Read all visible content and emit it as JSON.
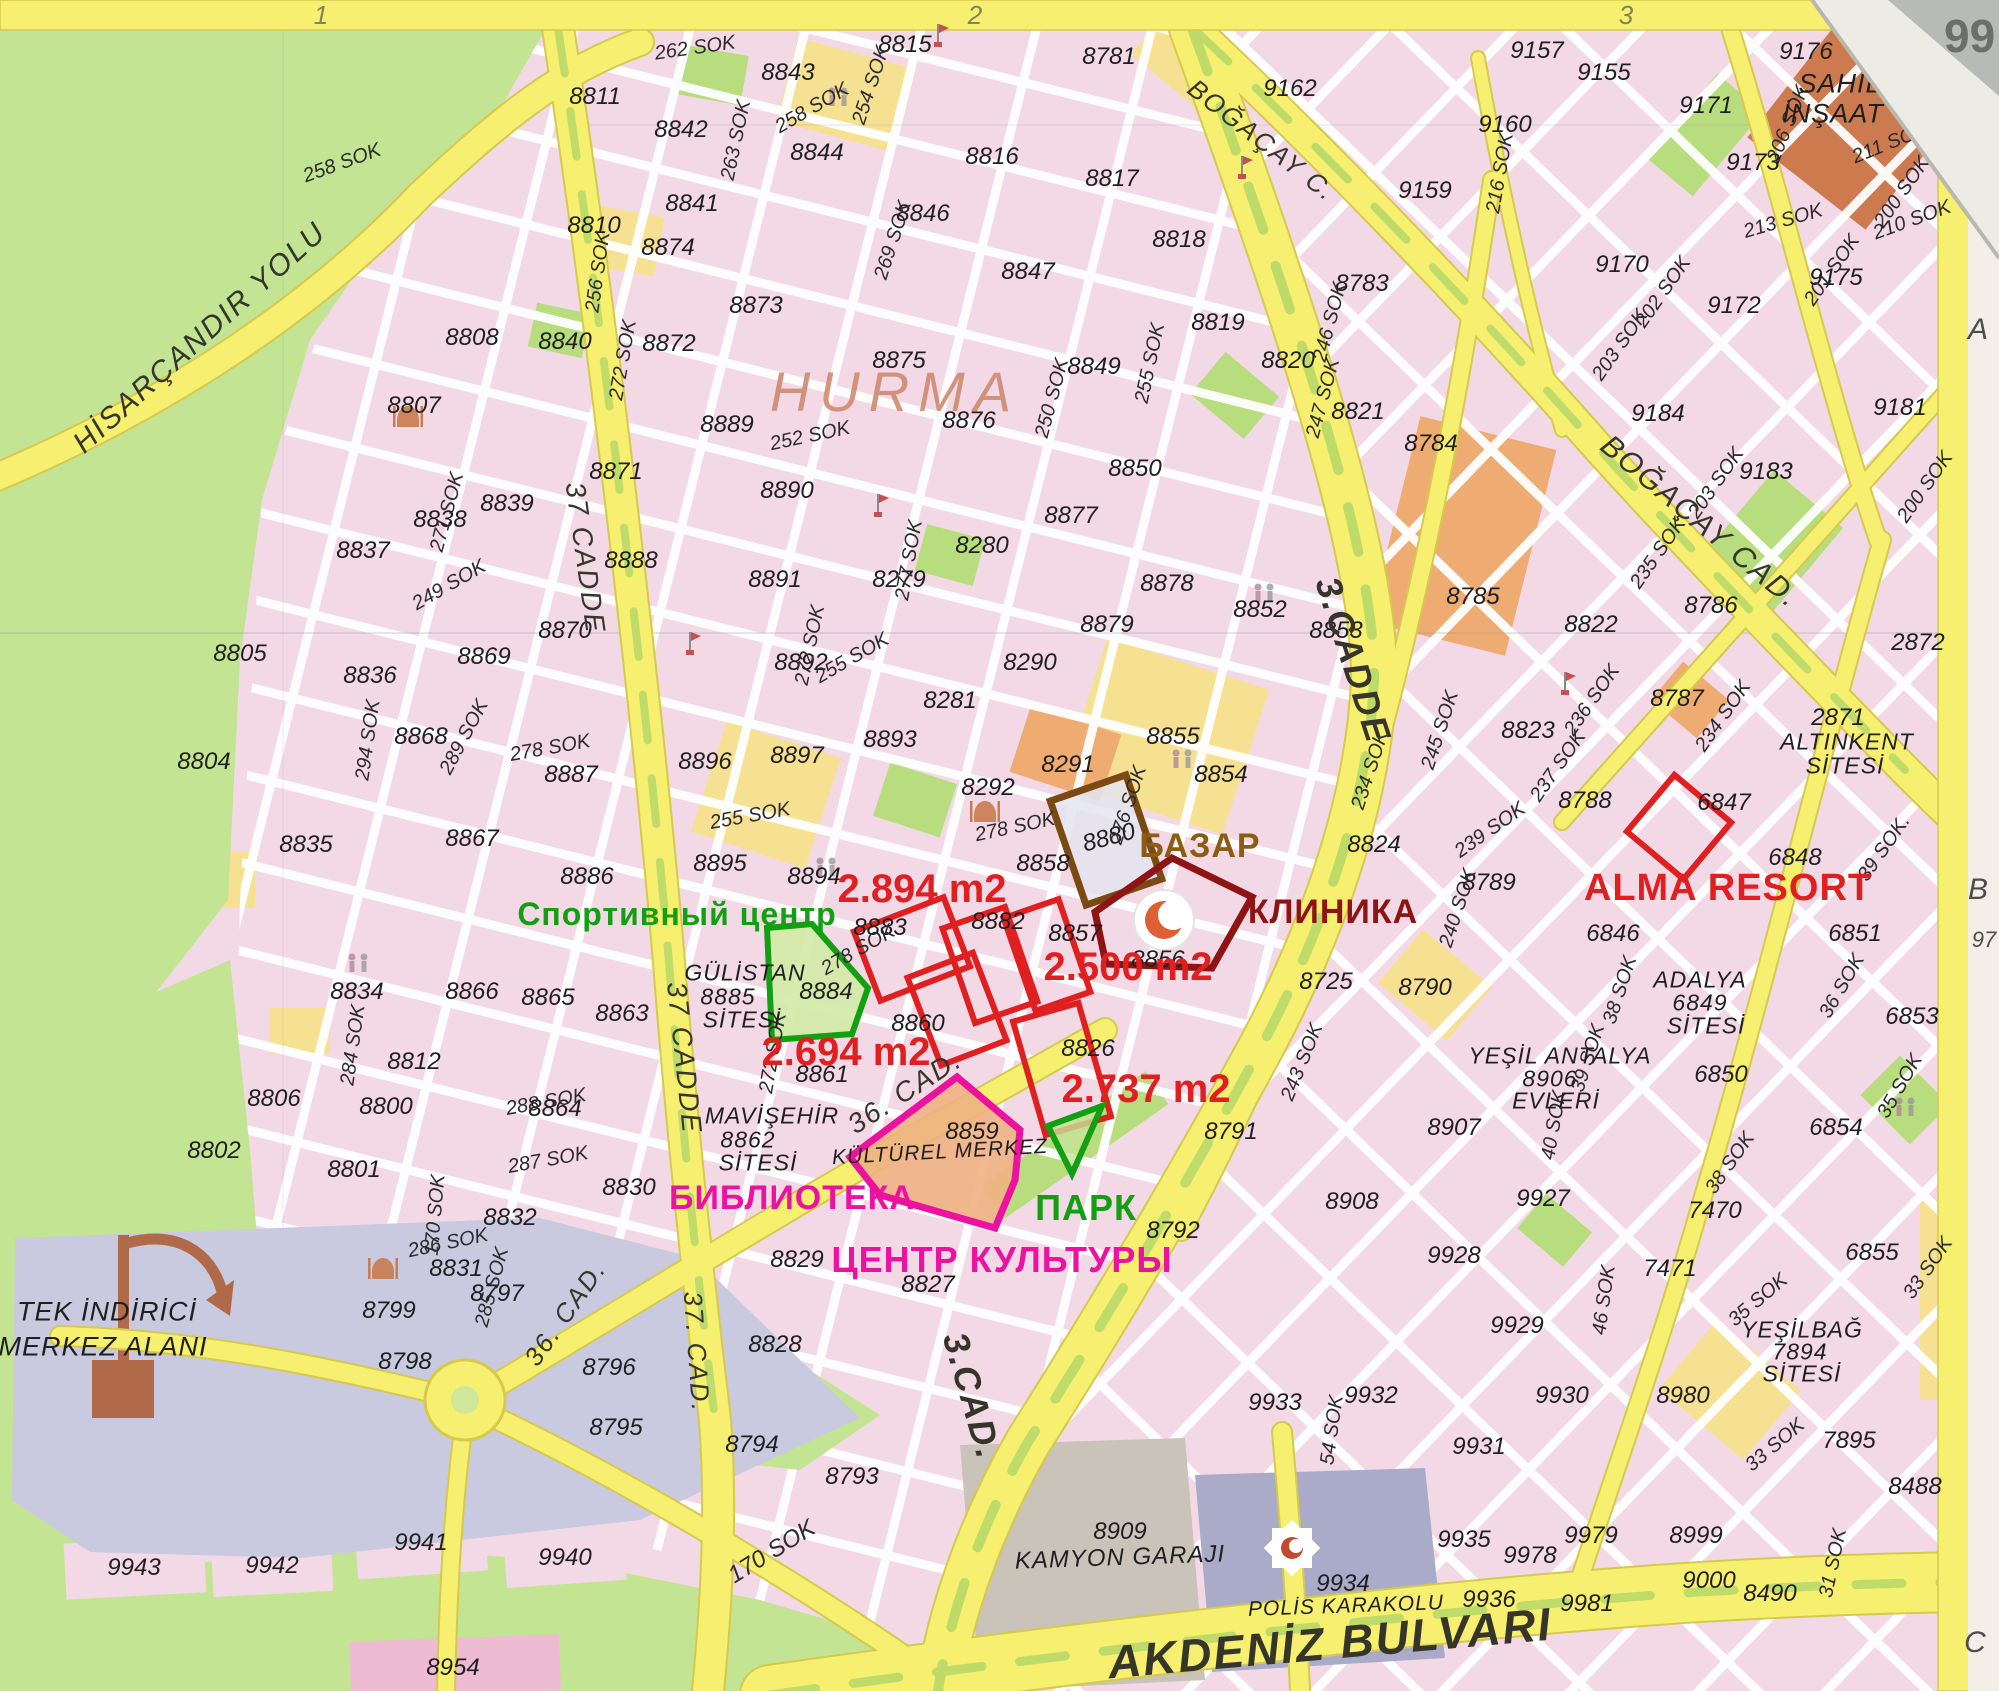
{
  "colors": {
    "red": "#e02020",
    "darkred": "#8e1414",
    "brown": "#8a5c14",
    "brown_shape": "#7a4a12",
    "green": "#12a012",
    "magenta": "#ec12a0",
    "hurma": "#cf8a70",
    "road_yellow": "#f6ef6f",
    "pink_block": "#f3d9e6",
    "country_green": "#c3e493",
    "lavender": "#c9c9df",
    "grey_area": "#c9c3ba",
    "police_blue": "#a9abc9"
  },
  "region": {
    "name": "HURMA",
    "x": 895,
    "y": 392,
    "size": 56
  },
  "grid": {
    "top": [
      [
        "1",
        321,
        15
      ],
      [
        "2",
        975,
        15
      ],
      [
        "3",
        1626,
        15
      ]
    ],
    "right": [
      [
        "A",
        1978,
        330
      ],
      [
        "B",
        1978,
        890
      ],
      [
        "97",
        1984,
        940
      ],
      [
        "C",
        1975,
        1643
      ]
    ],
    "corner": "99"
  },
  "labels": {
    "blocks": [
      [
        "8843",
        788,
        73
      ],
      [
        "8815",
        905,
        45
      ],
      [
        "8781",
        1109,
        57
      ],
      [
        "8816",
        992,
        157
      ],
      [
        "8817",
        1112,
        179
      ],
      [
        "8811",
        595,
        97
      ],
      [
        "8842",
        681,
        130
      ],
      [
        "8844",
        817,
        153
      ],
      [
        "8846",
        923,
        214
      ],
      [
        "8810",
        594,
        226
      ],
      [
        "8841",
        692,
        204
      ],
      [
        "8847",
        1028,
        272
      ],
      [
        "8818",
        1179,
        240
      ],
      [
        "8819",
        1218,
        323
      ],
      [
        "8820",
        1288,
        361
      ],
      [
        "8821",
        1358,
        412
      ],
      [
        "8783",
        1362,
        284
      ],
      [
        "8784",
        1431,
        444
      ],
      [
        "8808",
        472,
        338
      ],
      [
        "8807",
        414,
        406
      ],
      [
        "8872",
        669,
        344
      ],
      [
        "8873",
        756,
        306
      ],
      [
        "8875",
        899,
        361
      ],
      [
        "8876",
        969,
        421
      ],
      [
        "8849",
        1094,
        367
      ],
      [
        "8850",
        1135,
        469
      ],
      [
        "8839",
        507,
        504
      ],
      [
        "8838",
        440,
        520
      ],
      [
        "8837",
        363,
        551
      ],
      [
        "8840",
        565,
        342
      ],
      [
        "8871",
        616,
        472
      ],
      [
        "8889",
        727,
        425
      ],
      [
        "8890",
        787,
        491
      ],
      [
        "8891",
        775,
        580
      ],
      [
        "8892",
        801,
        663
      ],
      [
        "8888",
        631,
        561
      ],
      [
        "8870",
        565,
        631
      ],
      [
        "8869",
        484,
        657
      ],
      [
        "8868",
        421,
        737
      ],
      [
        "8836",
        370,
        676
      ],
      [
        "8805",
        240,
        654
      ],
      [
        "8804",
        204,
        762
      ],
      [
        "8835",
        306,
        845
      ],
      [
        "8867",
        472,
        839
      ],
      [
        "8887",
        571,
        775
      ],
      [
        "8896",
        705,
        762
      ],
      [
        "8897",
        797,
        756
      ],
      [
        "8893",
        890,
        740
      ],
      [
        "8281",
        950,
        701
      ],
      [
        "8280",
        982,
        546
      ],
      [
        "8279",
        899,
        580
      ],
      [
        "8290",
        1030,
        663
      ],
      [
        "8291",
        1068,
        765
      ],
      [
        "8292",
        988,
        788
      ],
      [
        "8877",
        1071,
        516
      ],
      [
        "8878",
        1167,
        584
      ],
      [
        "8879",
        1107,
        625
      ],
      [
        "8852",
        1260,
        610
      ],
      [
        "8853",
        1336,
        631
      ],
      [
        "8855",
        1173,
        737
      ],
      [
        "8854",
        1221,
        775
      ],
      [
        "8785",
        1473,
        597
      ],
      [
        "8786",
        1711,
        606
      ],
      [
        "8822",
        1591,
        625
      ],
      [
        "8823",
        1528,
        731
      ],
      [
        "8787",
        1677,
        699
      ],
      [
        "2872",
        1918,
        643
      ],
      [
        "2871",
        1838,
        718
      ],
      [
        "8788",
        1585,
        801
      ],
      [
        "8789",
        1489,
        883
      ],
      [
        "8824",
        1374,
        845
      ],
      [
        "6847",
        1724,
        803
      ],
      [
        "6848",
        1795,
        858
      ],
      [
        "6846",
        1613,
        934
      ],
      [
        "6851",
        1855,
        934
      ],
      [
        "6853",
        1912,
        1017
      ],
      [
        "6850",
        1721,
        1075
      ],
      [
        "6854",
        1836,
        1128
      ],
      [
        "6855",
        1872,
        1253
      ],
      [
        "8725",
        1326,
        982
      ],
      [
        "8790",
        1425,
        988
      ],
      [
        "8907",
        1454,
        1128
      ],
      [
        "9927",
        1543,
        1199
      ],
      [
        "7470",
        1715,
        1211
      ],
      [
        "7471",
        1670,
        1269
      ],
      [
        "9928",
        1454,
        1256
      ],
      [
        "9929",
        1517,
        1326
      ],
      [
        "9930",
        1562,
        1396
      ],
      [
        "9931",
        1479,
        1447
      ],
      [
        "8980",
        1683,
        1396
      ],
      [
        "7895",
        1849,
        1441
      ],
      [
        "8488",
        1915,
        1487
      ],
      [
        "8490",
        1770,
        1594
      ],
      [
        "8999",
        1696,
        1536
      ],
      [
        "9000",
        1709,
        1581
      ],
      [
        "9979",
        1591,
        1536
      ],
      [
        "9978",
        1530,
        1556
      ],
      [
        "9935",
        1464,
        1540
      ],
      [
        "9936",
        1489,
        1600
      ],
      [
        "9981",
        1587,
        1604
      ],
      [
        "9933",
        1275,
        1403
      ],
      [
        "9932",
        1371,
        1396
      ],
      [
        "8908",
        1352,
        1202
      ],
      [
        "8791",
        1231,
        1132
      ],
      [
        "8792",
        1173,
        1231
      ],
      [
        "9943",
        134,
        1568
      ],
      [
        "9942",
        272,
        1566
      ],
      [
        "9941",
        421,
        1543
      ],
      [
        "9940",
        565,
        1558
      ],
      [
        "8954",
        453,
        1668
      ],
      [
        "8795",
        616,
        1428
      ],
      [
        "8794",
        752,
        1445
      ],
      [
        "8793",
        852,
        1477
      ],
      [
        "8796",
        609,
        1368
      ],
      [
        "8798",
        405,
        1362
      ],
      [
        "8799",
        389,
        1311
      ],
      [
        "8797",
        497,
        1294
      ],
      [
        "8831",
        456,
        1269
      ],
      [
        "8832",
        510,
        1218
      ],
      [
        "8830",
        629,
        1188
      ],
      [
        "8829",
        797,
        1260
      ],
      [
        "8827",
        928,
        1285
      ],
      [
        "8828",
        775,
        1345
      ],
      [
        "8802",
        214,
        1151
      ],
      [
        "8801",
        354,
        1170
      ],
      [
        "8800",
        386,
        1107
      ],
      [
        "8806",
        274,
        1099
      ],
      [
        "8812",
        414,
        1062
      ],
      [
        "8864",
        555,
        1109
      ],
      [
        "8863",
        622,
        1014
      ],
      [
        "8861",
        822,
        1075
      ],
      [
        "8860",
        918,
        1024
      ],
      [
        "8858",
        1043,
        864
      ],
      [
        "8857",
        1075,
        934
      ],
      [
        "8856",
        1158,
        960
      ],
      [
        "8826",
        1088,
        1049
      ],
      [
        "8880",
        1109,
        838,
        -15
      ],
      [
        "8882",
        998,
        922
      ],
      [
        "8883",
        880,
        928
      ],
      [
        "8884",
        826,
        992
      ],
      [
        "8886",
        587,
        877
      ],
      [
        "8895",
        720,
        864
      ],
      [
        "8894",
        814,
        877
      ],
      [
        "8834",
        357,
        992
      ],
      [
        "8866",
        472,
        992
      ],
      [
        "8865",
        548,
        998
      ],
      [
        "8859",
        972,
        1132
      ],
      [
        "9157",
        1537,
        51
      ],
      [
        "9155",
        1604,
        73
      ],
      [
        "9162",
        1290,
        89
      ],
      [
        "9159",
        1425,
        191
      ],
      [
        "9160",
        1505,
        125
      ],
      [
        "9171",
        1706,
        106
      ],
      [
        "9173",
        1753,
        163
      ],
      [
        "9175",
        1836,
        278
      ],
      [
        "9172",
        1734,
        306
      ],
      [
        "9170",
        1622,
        265
      ],
      [
        "9184",
        1658,
        414
      ],
      [
        "9183",
        1766,
        472
      ],
      [
        "9181",
        1900,
        408
      ],
      [
        "9176",
        1806,
        52
      ],
      [
        "8909",
        1120,
        1532
      ],
      [
        "9934",
        1343,
        1584
      ],
      [
        "8874",
        668,
        248
      ]
    ],
    "streets": [
      [
        "262 SOK",
        695,
        48,
        -8
      ],
      [
        "258 SOK",
        812,
        108,
        -30
      ],
      [
        "254 SOK",
        871,
        85,
        -72
      ],
      [
        "269 SOK",
        893,
        240,
        -72
      ],
      [
        "263 SOK",
        736,
        140,
        -78
      ],
      [
        "256 SOK",
        598,
        272,
        -82
      ],
      [
        "258 SOK",
        342,
        163,
        -20
      ],
      [
        "252 SOK",
        810,
        436,
        -12
      ],
      [
        "250 SOK",
        1052,
        398,
        -75
      ],
      [
        "255 SOK",
        1150,
        363,
        -78
      ],
      [
        "255 SOK",
        852,
        658,
        -30
      ],
      [
        "255 SOK",
        750,
        816,
        -10
      ],
      [
        "249 SOK",
        449,
        585,
        -30
      ],
      [
        "271 SOK",
        447,
        512,
        -75
      ],
      [
        "272 SOK",
        623,
        360,
        -80
      ],
      [
        "272 SOK",
        810,
        645,
        -78
      ],
      [
        "272 SOK",
        773,
        1053,
        -80
      ],
      [
        "277 SOK",
        909,
        560,
        -80
      ],
      [
        "278 SOK",
        550,
        748,
        -10
      ],
      [
        "278 SOK",
        1015,
        827,
        -12
      ],
      [
        "278 SOK",
        858,
        950,
        -30
      ],
      [
        "276 SOK",
        1128,
        805,
        -72
      ],
      [
        "289 SOK",
        464,
        737,
        -62
      ],
      [
        "294 SOK",
        368,
        740,
        -82
      ],
      [
        "284 SOK",
        353,
        1045,
        -82
      ],
      [
        "288 SOK",
        546,
        1102,
        -10
      ],
      [
        "287 SOK",
        548,
        1160,
        -10
      ],
      [
        "286 SOK",
        448,
        1243,
        -12
      ],
      [
        "285 SOK",
        492,
        1287,
        -75
      ],
      [
        "170 SOK",
        435,
        1215,
        -85
      ],
      [
        "170 SOK",
        772,
        1552,
        -32,
        24
      ],
      [
        "246 SOK",
        1330,
        322,
        -75
      ],
      [
        "247 SOK",
        1323,
        398,
        -75
      ],
      [
        "245 SOK",
        1440,
        730,
        -72
      ],
      [
        "243 SOK",
        1302,
        1062,
        -68
      ],
      [
        "240 SOK",
        1458,
        908,
        -72
      ],
      [
        "239 SOK",
        1490,
        830,
        -35
      ],
      [
        "236 SOK",
        1592,
        700,
        -55
      ],
      [
        "235 SOK",
        1658,
        553,
        -55
      ],
      [
        "234 SOK",
        1723,
        716,
        -55
      ],
      [
        "234 SOK",
        1370,
        770,
        -72
      ],
      [
        "237 SOK",
        1558,
        766,
        -55
      ],
      [
        "216 SOK",
        1500,
        173,
        -80
      ],
      [
        "213 SOK",
        1783,
        221,
        -16
      ],
      [
        "206 SOK",
        1788,
        124,
        -68
      ],
      [
        "211 SOK",
        1890,
        143,
        -22
      ],
      [
        "210 SOK",
        1912,
        220,
        -20
      ],
      [
        "203 SOK",
        1716,
        483,
        -55
      ],
      [
        "203 SOK",
        1620,
        345,
        -55
      ],
      [
        "202 SOK",
        1663,
        292,
        -55
      ],
      [
        "201 SOK",
        1832,
        270,
        -55
      ],
      [
        "200 SOK",
        1902,
        192,
        -55
      ],
      [
        "200 SOK",
        1925,
        487,
        -55
      ],
      [
        "39 SOK",
        1588,
        1058,
        -72
      ],
      [
        "39 SOK.",
        1884,
        848,
        -55
      ],
      [
        "38 SOK",
        1620,
        990,
        -72
      ],
      [
        "38 SOK",
        1730,
        1163,
        -55
      ],
      [
        "40 SOK",
        1554,
        1125,
        -80
      ],
      [
        "36 SOK",
        1842,
        986,
        -60
      ],
      [
        "35 SOK",
        1900,
        1086,
        -60
      ],
      [
        "35 SOK",
        1758,
        1300,
        -40
      ],
      [
        "33 SOK",
        1928,
        1268,
        -55
      ],
      [
        "33 SOK",
        1775,
        1445,
        -40
      ],
      [
        "31 SOK",
        1833,
        1563,
        -78
      ],
      [
        "54 SOK",
        1332,
        1430,
        -82
      ],
      [
        "46 SOK",
        1604,
        1300,
        -82
      ]
    ],
    "roads": [
      [
        "HİSARÇANDIR YOLU",
        200,
        338,
        -42,
        30
      ],
      [
        "37 CADDE",
        585,
        558,
        82,
        28
      ],
      [
        "37 CADDE",
        684,
        1058,
        84,
        28
      ],
      [
        "37. CAD.",
        697,
        1352,
        86,
        26
      ],
      [
        "36. CAD.",
        905,
        1092,
        -33,
        28
      ],
      [
        "36. CAD.",
        565,
        1313,
        -55,
        26
      ],
      [
        "3.CADDE",
        1353,
        660,
        72,
        36
      ],
      [
        "3.CAD.",
        972,
        1396,
        74,
        36
      ],
      [
        "BOĞAÇAY C.",
        1262,
        140,
        38,
        26
      ],
      [
        "BOĞAÇAY CAD.",
        1700,
        522,
        40,
        30
      ],
      [
        "AKDENİZ BULVARI",
        1330,
        1643,
        -5,
        46
      ]
    ],
    "sites": [
      [
        "GÜLİSTAN",
        745,
        973
      ],
      [
        "8885",
        728,
        997
      ],
      [
        "SİTESİ",
        742,
        1020
      ],
      [
        "MAVİŞEHİR",
        772,
        1116
      ],
      [
        "8862",
        748,
        1140
      ],
      [
        "SİTESİ",
        758,
        1163
      ],
      [
        "KÜLTÜREL MERKEZ",
        940,
        1152,
        21,
        -3
      ],
      [
        "ADALYA",
        1700,
        980
      ],
      [
        "6849",
        1700,
        1003
      ],
      [
        "SİTESİ",
        1706,
        1026
      ],
      [
        "YEŞİL ANTALYA",
        1560,
        1056
      ],
      [
        "8906",
        1550,
        1079
      ],
      [
        "EVLERİ",
        1556,
        1101
      ],
      [
        "ALTINKENT",
        1847,
        742
      ],
      [
        "SİTESİ",
        1845,
        766
      ],
      [
        "YEŞİLBAĞ",
        1802,
        1330
      ],
      [
        "7894",
        1800,
        1352
      ],
      [
        "SİTESİ",
        1802,
        1374
      ],
      [
        "SAHİL",
        1840,
        84,
        27
      ],
      [
        "İNŞAAT",
        1833,
        114,
        27
      ],
      [
        "TEK İNDİRİCİ",
        107,
        1312,
        27
      ],
      [
        "MERKEZ ALANI",
        103,
        1347,
        27
      ],
      [
        "KAMYON GARAJI",
        1120,
        1558,
        24,
        -2
      ],
      [
        "POLİS KARAKOLU",
        1346,
        1606,
        21,
        -2
      ],
      [
        "HURMA",
        0,
        0,
        0
      ]
    ]
  },
  "annotations": {
    "areas": [
      [
        "2.894 m2",
        922,
        889,
        40
      ],
      [
        "2.694 m2",
        846,
        1052,
        40
      ],
      [
        "2.500 m2",
        1128,
        967,
        40
      ],
      [
        "2.737 m2",
        1146,
        1089,
        40
      ]
    ],
    "names": [
      [
        "Спортивный центр",
        677,
        914,
        "green",
        32
      ],
      [
        "БАЗАР",
        1200,
        846,
        "brown",
        34
      ],
      [
        "КЛИНИКА",
        1333,
        912,
        "darkred",
        34
      ],
      [
        "ALMA  RESORT",
        1728,
        888,
        "red",
        38
      ],
      [
        "БИБЛИОТЕКА",
        792,
        1198,
        "magenta",
        34
      ],
      [
        "ПАРК",
        1086,
        1208,
        "green",
        36
      ],
      [
        "ЦЕНТР КУЛЬТУРЫ",
        1002,
        1260,
        "magenta",
        36
      ]
    ]
  }
}
